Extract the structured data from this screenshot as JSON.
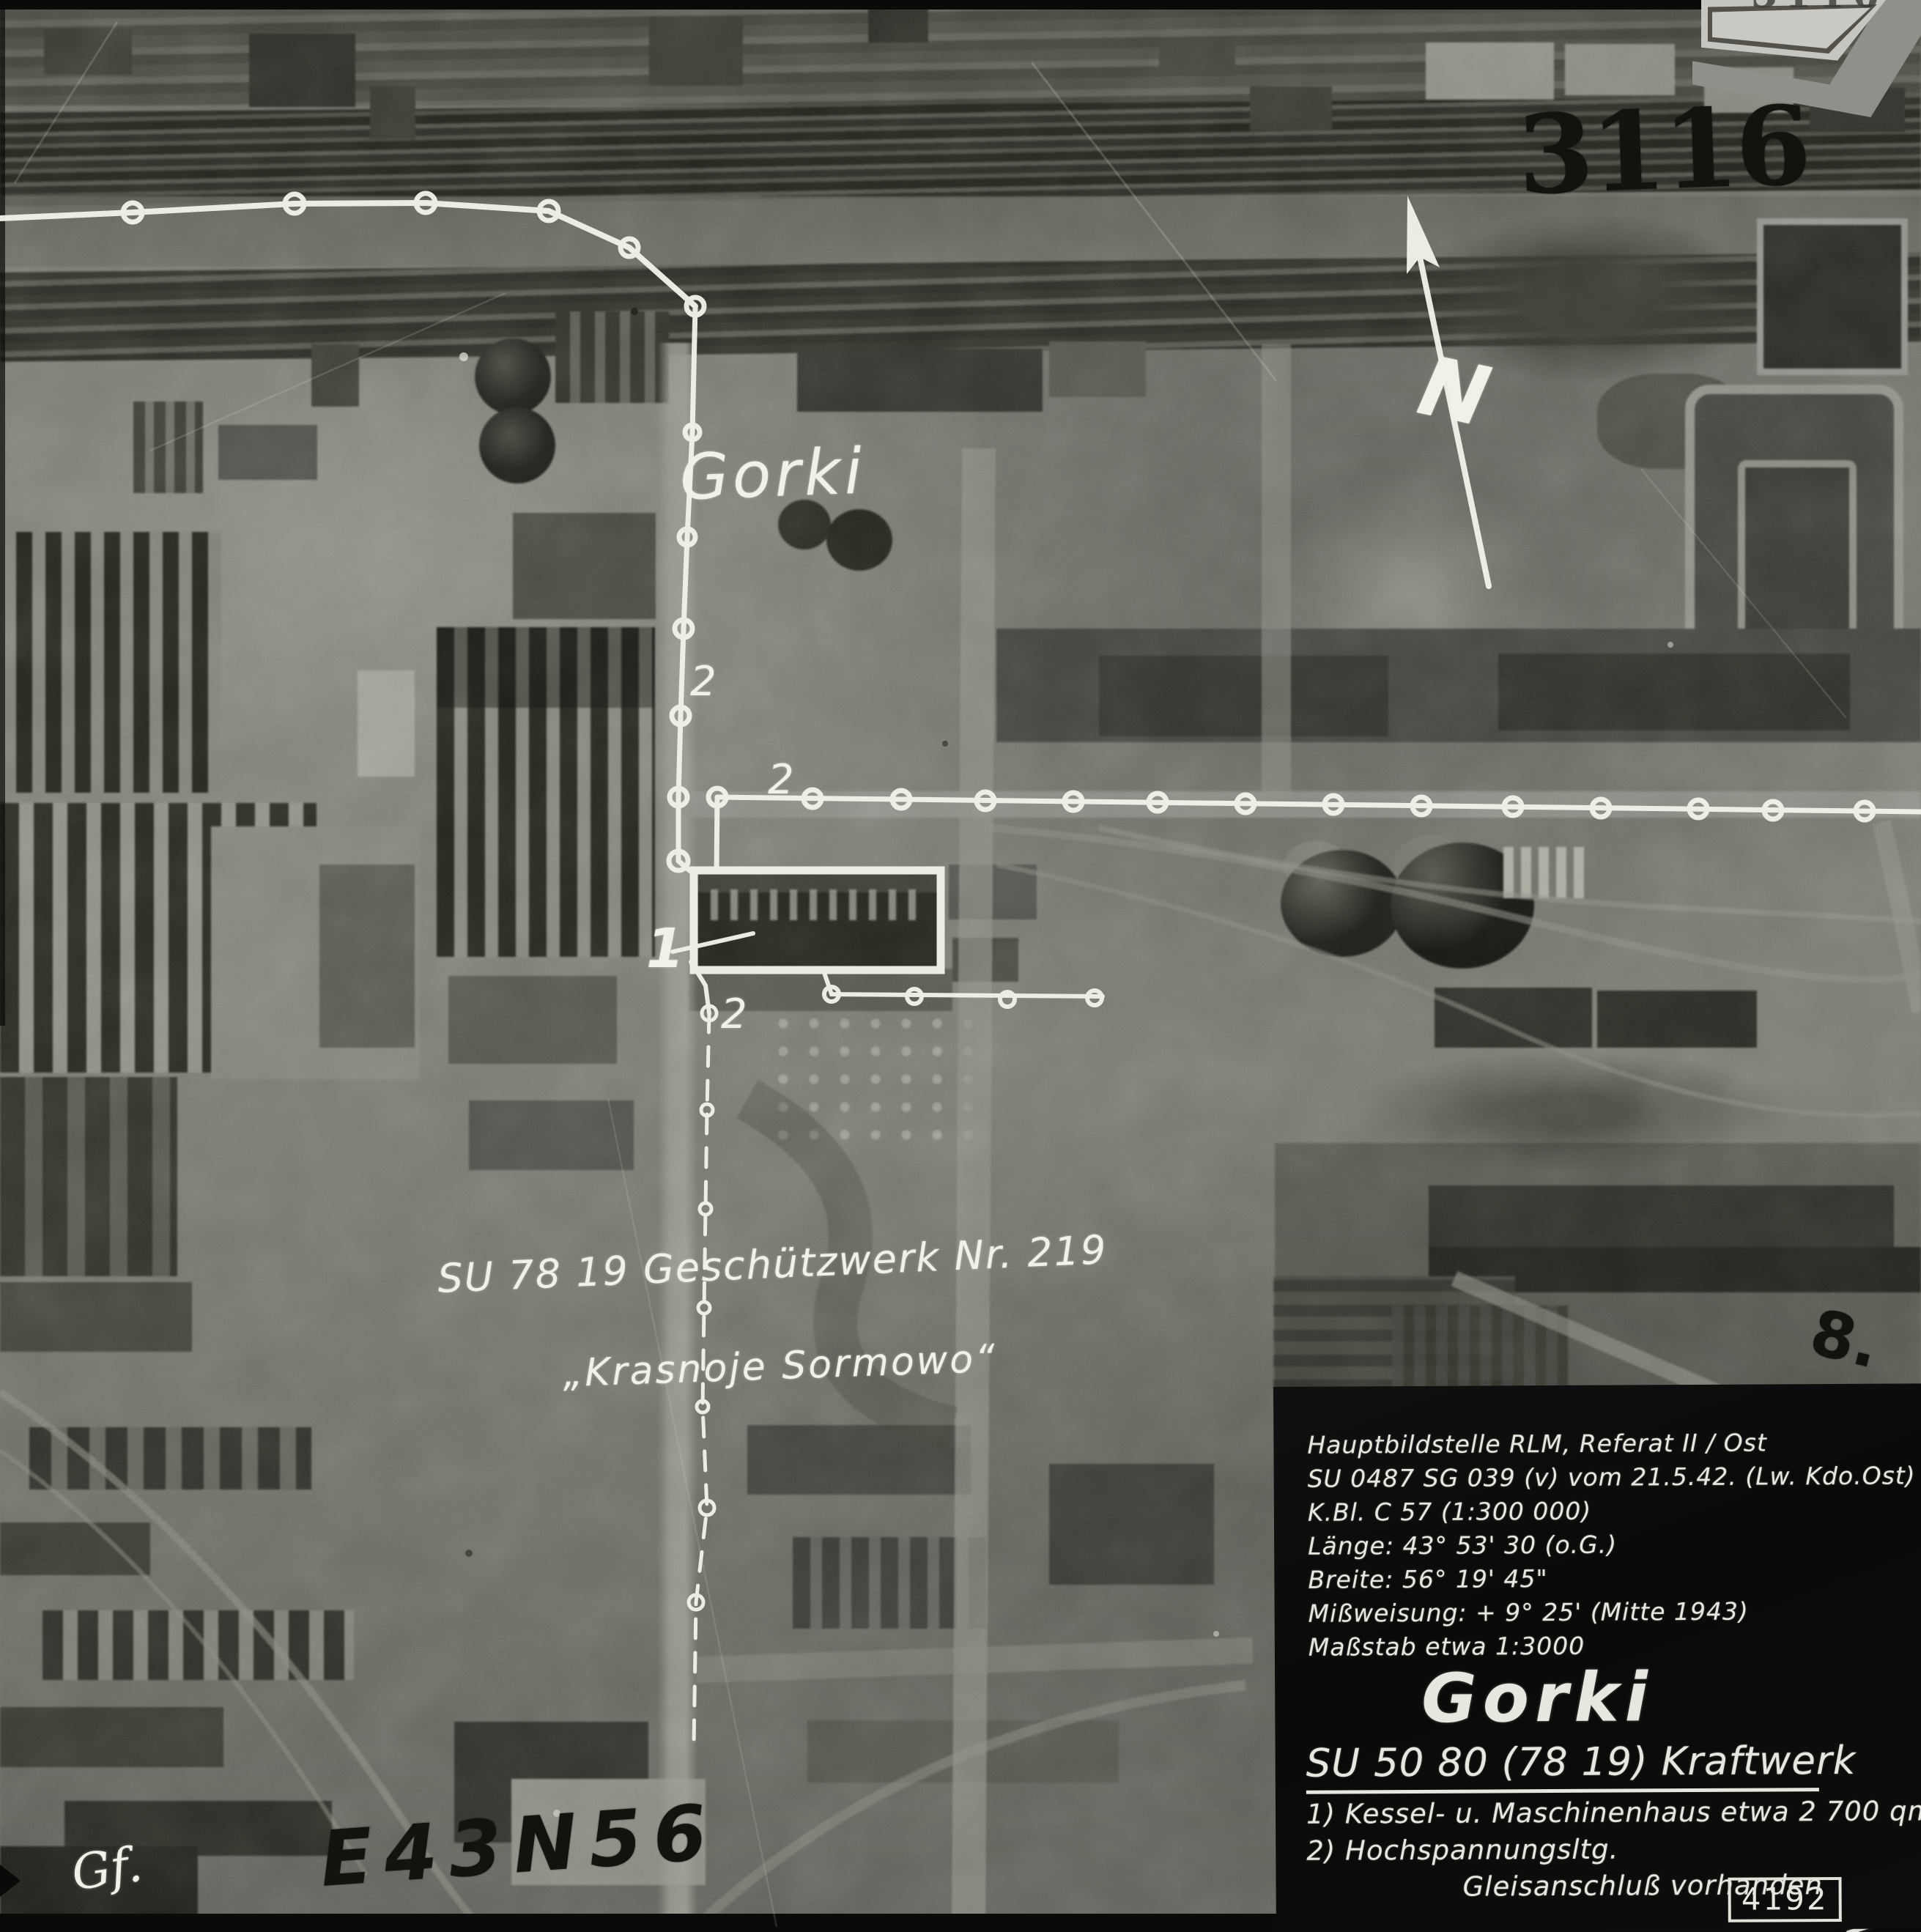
{
  "photo_labels": {
    "place": "Gorki",
    "target_line1": "SU 78 19 Geschützwerk Nr. 219",
    "target_line2": "„Krasnoje Sormowo“",
    "marker_1": "1",
    "marker_2": "2",
    "frame_stamp": "3116",
    "grid_reference": "E43N56",
    "sheet_mark": "8.",
    "corner_signature": "Gf.",
    "edge_scribble": "B"
  },
  "plaque": {
    "partial_number": "3116"
  },
  "north_arrow": {
    "label": "N"
  },
  "info_panel": {
    "lines": [
      "Hauptbildstelle RLM, Referat II / Ost",
      "SU 0487 SG 039 (v) vom 21.5.42. (Lw. Kdo.Ost)",
      "K.Bl. C 57 (1:300 000)",
      "Länge: 43° 53' 30 (o.G.)",
      "Breite: 56° 19' 45\"",
      "Mißweisung: + 9° 25' (Mitte 1943)",
      "Maßstab etwa 1:3000"
    ],
    "title": "Gorki",
    "subtitle": "SU 50 80 (78 19) Kraftwerk",
    "items": [
      "1) Kessel- u. Maschinenhaus  etwa 2 700 qm",
      "2) Hochspannungsltg."
    ],
    "footer": "Gleisanschluß vorhanden",
    "ref_number": "4192"
  },
  "colors": {
    "annotation_white": "#f2f2ea",
    "stamp_black": "#101010",
    "panel_bg": "#0b0b0a",
    "panel_text": "#e7e7df"
  }
}
